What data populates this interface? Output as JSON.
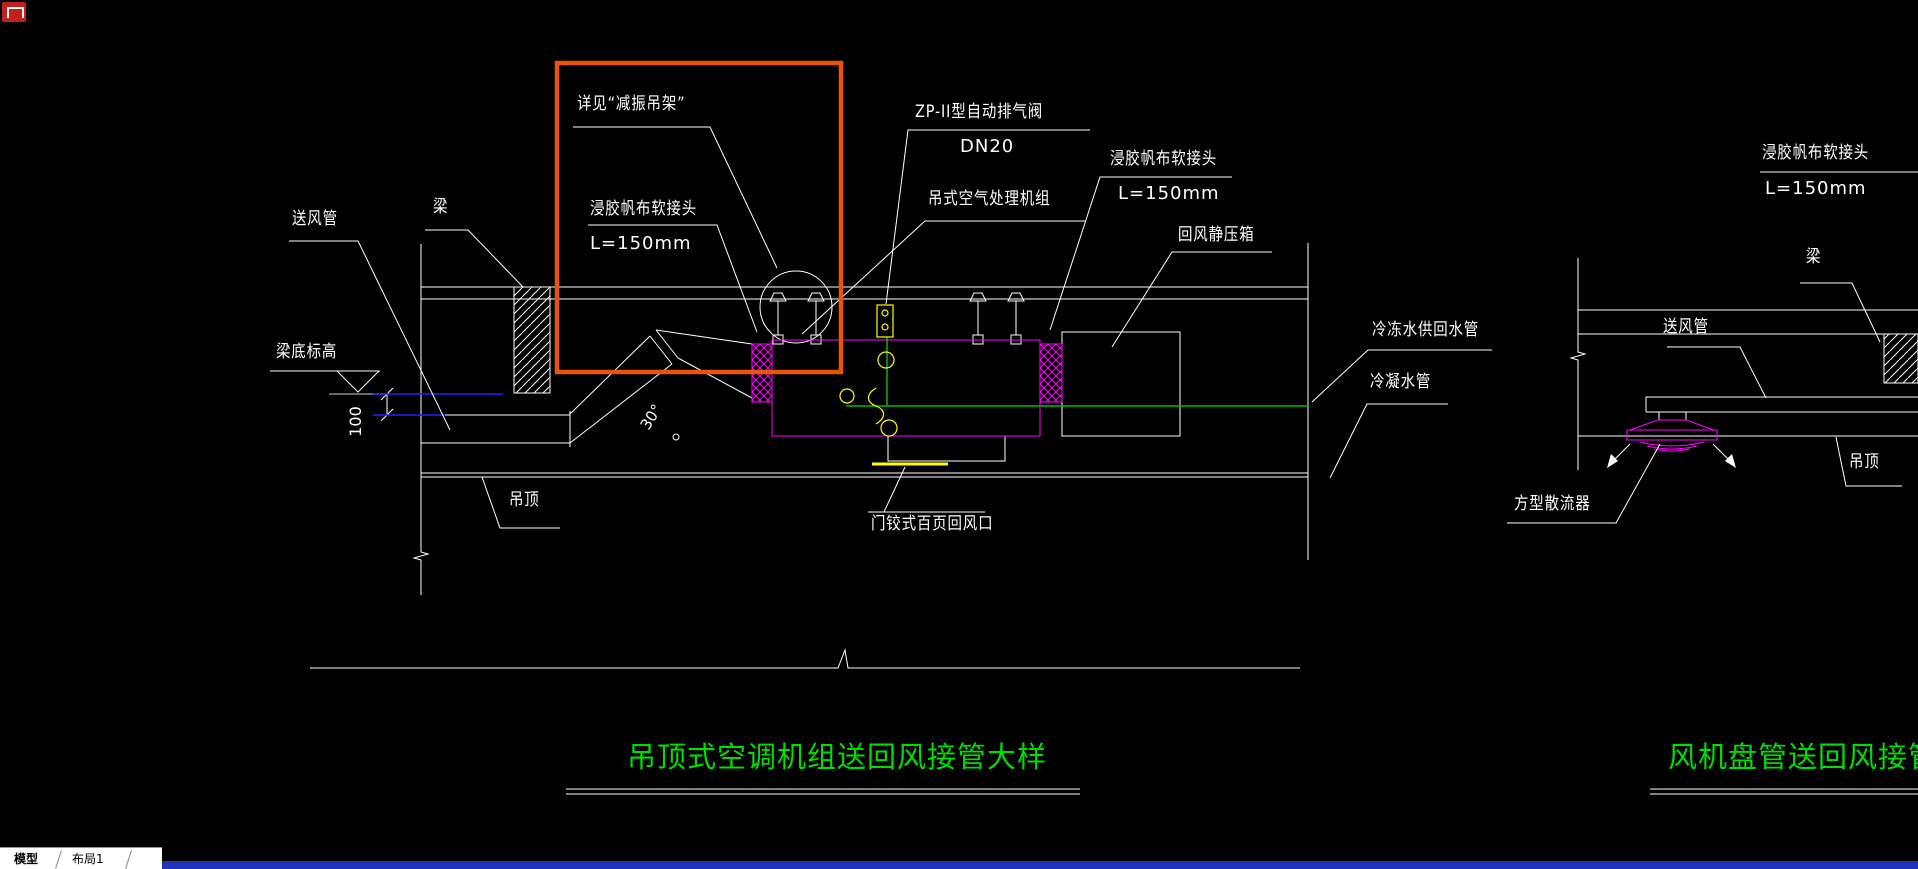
{
  "app": {
    "tabs": [
      {
        "label": "模型"
      },
      {
        "label": "布局1"
      }
    ]
  },
  "colors": {
    "background": "#000000",
    "drawing_line": "#ffffff",
    "highlight_orange": "#e8540a",
    "equipment_magenta": "#ff00ff",
    "pipe_green": "#00bb00",
    "title_green": "#00dd00",
    "valve_yellow": "#ffff00",
    "dimension_blue": "#2222ff",
    "reference_gray": "#8c8c8c",
    "tab_strip_blue": "#2233bb"
  },
  "left": {
    "title": "吊顶式空调机组送回风接管大样",
    "supply_duct": "送风管",
    "beam": "梁",
    "beam_bottom_level": "梁底标高",
    "dim_100": "100",
    "angle_30": "30°",
    "see_vibration_hanger": "详见“减振吊架”",
    "flex_joint": "浸胶帆布软接头",
    "flex_joint_len": "L=150mm",
    "auto_air_vent": "ZP-II型自动排气阀",
    "auto_air_vent_dn": "DN20",
    "ahu": "吊式空气处理机组",
    "flex_joint2": "浸胶帆布软接头",
    "flex_joint2_len": "L=150mm",
    "return_plenum": "回风静压箱",
    "chw_supply_return_pipe": "冷冻水供回水管",
    "condensate_pipe": "冷凝水管",
    "ceiling": "吊顶",
    "hinged_louver": "门铰式百页回风口"
  },
  "right": {
    "title": "风机盘管送回风接管",
    "flex_joint": "浸胶帆布软接头",
    "flex_joint_len": "L=150mm",
    "beam": "梁",
    "supply_duct": "送风管",
    "ceiling": "吊顶",
    "square_diffuser": "方型散流器"
  }
}
